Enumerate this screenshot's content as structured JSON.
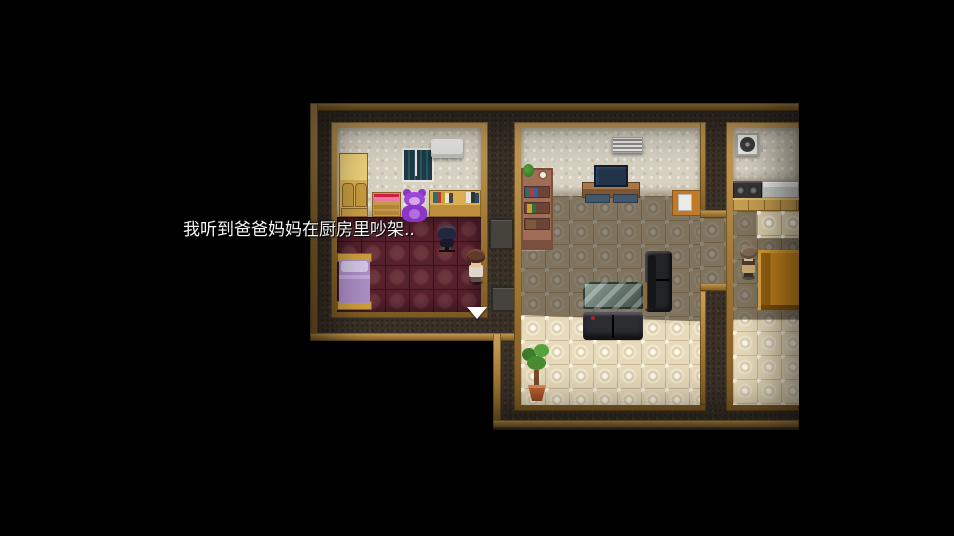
{
  "game": {
    "dialogue_text": "我听到爸爸妈妈在厨房里吵架..",
    "indicator": "continue-arrow-down",
    "characters": [
      {
        "id": "player-child",
        "location": "bedroom"
      },
      {
        "id": "parent-npc",
        "location": "kitchen"
      }
    ],
    "rooms": [
      {
        "name": "bedroom",
        "furniture": [
          "wardrobe",
          "window",
          "air-conditioner",
          "dresser",
          "teddy-bear",
          "desk-with-books",
          "office-chair",
          "bed",
          "door-mat"
        ]
      },
      {
        "name": "living-room",
        "furniture": [
          "bookshelf",
          "wall-vent",
          "tv-on-stand",
          "corner-sofa",
          "sofa",
          "glass-coffee-table",
          "potted-plant",
          "side-cabinet"
        ]
      },
      {
        "name": "kitchen",
        "furniture": [
          "ventilation-fan",
          "stove",
          "kitchen-counter",
          "cabinets",
          "dining-table"
        ]
      }
    ],
    "colors": {
      "background": "#000000",
      "wall_dark": "#3a3128",
      "trim_gold": "#a57c38",
      "wall_cream": "#d7d1c2",
      "bedroom_floor": "#55222d",
      "tile_floor": "#e0d2b0",
      "dialogue_text": "#f8f8f8"
    }
  }
}
